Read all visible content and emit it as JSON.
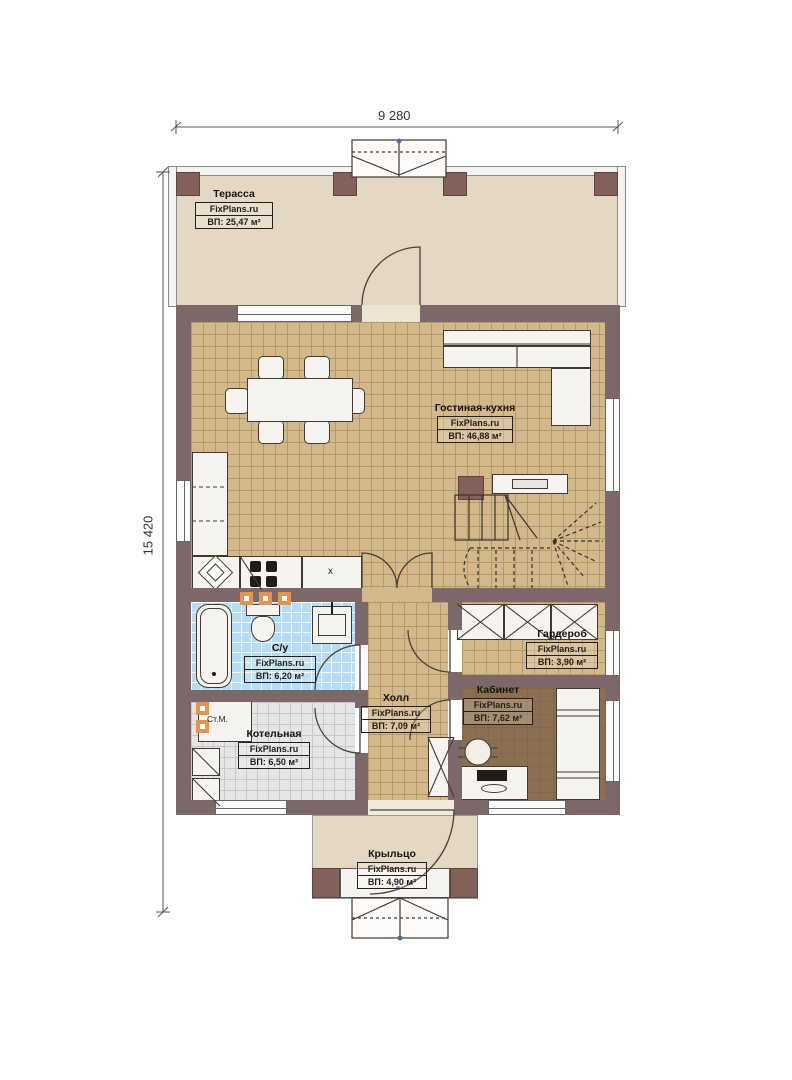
{
  "brand": "FixPlans.ru",
  "dimensions": {
    "width": "9 280",
    "height": "15 420"
  },
  "rooms": {
    "terrace": {
      "name": "Терасса",
      "area": "ВП: 25,47 м²"
    },
    "living": {
      "name": "Гостиная-кухня",
      "area": "ВП: 46,88 м²"
    },
    "bathroom": {
      "name": "С/у",
      "area": "ВП: 6,20 м²"
    },
    "hall": {
      "name": "Холл",
      "area": "ВП: 7,09 м²"
    },
    "wardrobe": {
      "name": "Гардероб",
      "area": "ВП: 3,90 м²"
    },
    "office": {
      "name": "Кабинет",
      "area": "ВП: 7,62 м²"
    },
    "boiler": {
      "name": "Котельная",
      "area": "ВП: 6,50 м²"
    },
    "porch": {
      "name": "Крыльцо",
      "area": "ВП: 4,90 м²"
    }
  },
  "annotations": {
    "washing_machine": "Ст.М.",
    "counter_mark": "x"
  },
  "colors": {
    "wall": "#7c6769",
    "floor_tan": "#d3b88b",
    "floor_blue": "#b7dcf4",
    "floor_gray": "#e5e5e7",
    "floor_office": "#8b6f50",
    "floor_terrace": "#e4d8c4",
    "accent_orange": "#e2954f"
  }
}
